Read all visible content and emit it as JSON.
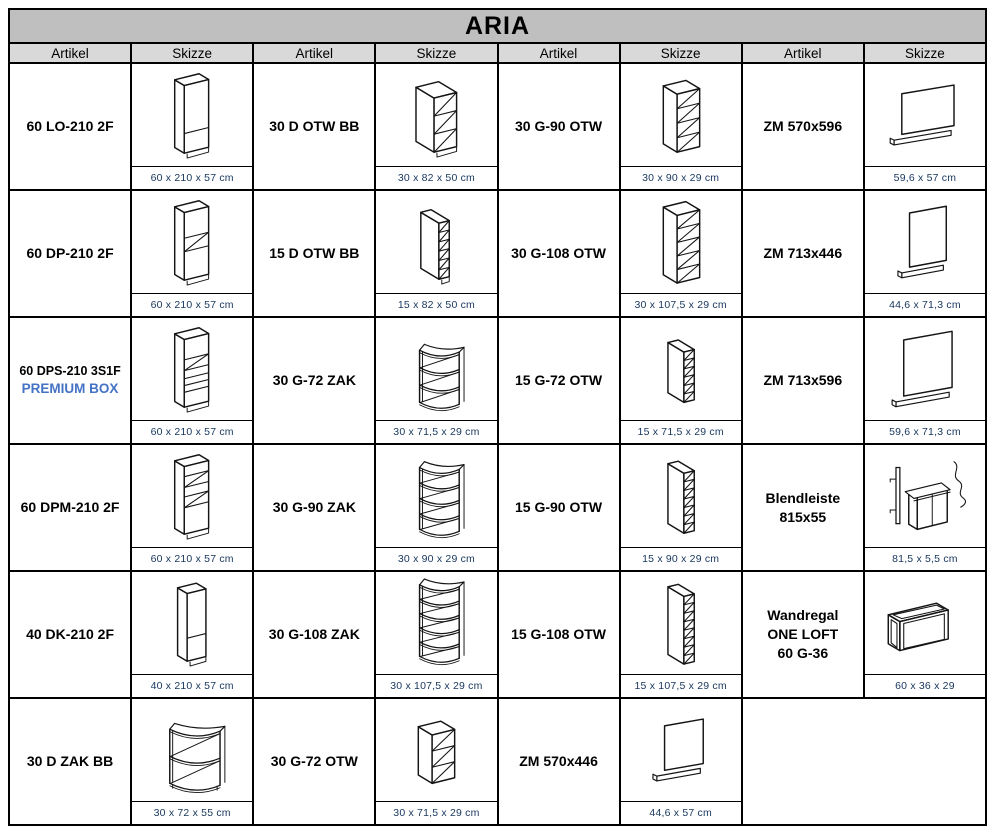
{
  "title": "ARIA",
  "column_headers": [
    "Artikel",
    "Skizze",
    "Artikel",
    "Skizze",
    "Artikel",
    "Skizze",
    "Artikel",
    "Skizze"
  ],
  "colors": {
    "title_bg": "#bfbfbf",
    "header_bg": "#d9d9d9",
    "border": "#000000",
    "dimension_text": "#17365d",
    "premium_accent": "#4472c4"
  },
  "items": [
    {
      "col": 1,
      "row": 1,
      "label": "60 LO-210 2F",
      "dims": "60 x 210 x 57 cm",
      "sketch": "tall-lo"
    },
    {
      "col": 1,
      "row": 2,
      "label": "60 DP-210 2F",
      "dims": "60 x 210 x 57 cm",
      "sketch": "tall-dp"
    },
    {
      "col": 1,
      "row": 3,
      "label": "60 DPS-210 3S1F",
      "accent": "PREMIUM BOX",
      "dims": "60 x 210 x 57 cm",
      "sketch": "tall-dps"
    },
    {
      "col": 1,
      "row": 4,
      "label": "60 DPM-210 2F",
      "dims": "60 x 210 x 57 cm",
      "sketch": "tall-dpm"
    },
    {
      "col": 1,
      "row": 5,
      "label": "40 DK-210 2F",
      "dims": "40 x 210 x 57 cm",
      "sketch": "tall-dk"
    },
    {
      "col": 1,
      "row": 6,
      "label": "30 D ZAK BB",
      "dims": "30 x 72 x 55 cm",
      "sketch": "zak-base"
    },
    {
      "col": 2,
      "row": 1,
      "label": "30 D OTW BB",
      "dims": "30 x 82 x 50 cm",
      "sketch": "otw-base-30"
    },
    {
      "col": 2,
      "row": 2,
      "label": "15 D OTW BB",
      "dims": "15 x 82 x 50 cm",
      "sketch": "otw-base-15"
    },
    {
      "col": 2,
      "row": 3,
      "label": "30 G-72 ZAK",
      "dims": "30 x 71,5 x 29 cm",
      "sketch": "zak-4"
    },
    {
      "col": 2,
      "row": 4,
      "label": "30 G-90 ZAK",
      "dims": "30 x 90 x 29 cm",
      "sketch": "zak-5"
    },
    {
      "col": 2,
      "row": 5,
      "label": "30 G-108 ZAK",
      "dims": "30 x 107,5 x 29 cm",
      "sketch": "zak-6"
    },
    {
      "col": 2,
      "row": 6,
      "label": "30 G-72 OTW",
      "dims": "30 x 71,5 x 29 cm",
      "sketch": "otw-3"
    },
    {
      "col": 3,
      "row": 1,
      "label": "30 G-90 OTW",
      "dims": "30 x 90 x 29 cm",
      "sketch": "otw-4"
    },
    {
      "col": 3,
      "row": 2,
      "label": "30 G-108 OTW",
      "dims": "30 x 107,5 x 29 cm",
      "sketch": "otw-5"
    },
    {
      "col": 3,
      "row": 3,
      "label": "15 G-72 OTW",
      "dims": "15 x 71,5 x 29 cm",
      "sketch": "otw-n6"
    },
    {
      "col": 3,
      "row": 4,
      "label": "15 G-90 OTW",
      "dims": "15 x 90 x 29 cm",
      "sketch": "otw-n7"
    },
    {
      "col": 3,
      "row": 5,
      "label": "15 G-108 OTW",
      "dims": "15 x 107,5 x 29 cm",
      "sketch": "otw-n8"
    },
    {
      "col": 3,
      "row": 6,
      "label": "ZM 570x446",
      "dims": "44,6 x 57 cm",
      "sketch": "panel-s"
    },
    {
      "col": 4,
      "row": 1,
      "label": "ZM 570x596",
      "dims": "59,6 x 57 cm",
      "sketch": "panel-w"
    },
    {
      "col": 4,
      "row": 2,
      "label": "ZM 713x446",
      "dims": "44,6 x 71,3 cm",
      "sketch": "panel-t"
    },
    {
      "col": 4,
      "row": 3,
      "label": "ZM 713x596",
      "dims": "59,6 x 71,3 cm",
      "sketch": "panel-l"
    },
    {
      "col": 4,
      "row": 4,
      "label": "Blendleiste",
      "line2": "815x55",
      "dims": "81,5 x 5,5 cm",
      "sketch": "blende"
    },
    {
      "col": 4,
      "row": 5,
      "label": "Wandregal",
      "line2": "ONE LOFT",
      "line3": "60 G-36",
      "dims": "60 x 36 x 29",
      "sketch": "frame"
    }
  ]
}
